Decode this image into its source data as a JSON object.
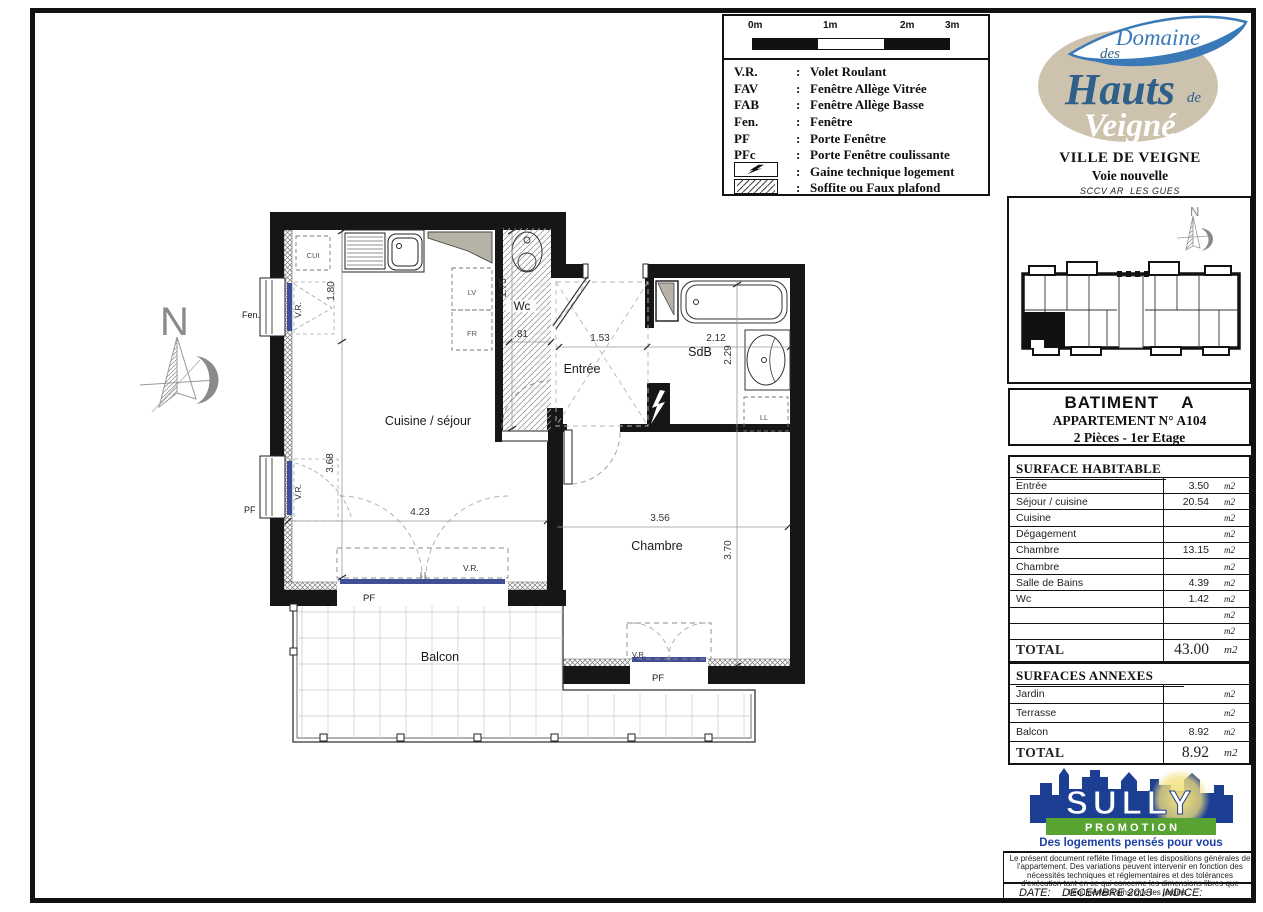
{
  "legend": {
    "scale_labels": [
      "0m",
      "1m",
      "2m",
      "3m"
    ],
    "entries": [
      {
        "abbr": "V.R.",
        "label": "Volet Roulant"
      },
      {
        "abbr": "FAV",
        "label": "Fenêtre Allège Vitrée"
      },
      {
        "abbr": "FAB",
        "label": "Fenêtre Allège Basse"
      },
      {
        "abbr": "Fen.",
        "label": "Fenêtre"
      },
      {
        "abbr": "PF",
        "label": "Porte Fenêtre"
      },
      {
        "abbr": "PFc",
        "label": "Porte Fenêtre coulissante"
      },
      {
        "abbr": "gaine-icon",
        "label": "Gaine technique logement"
      },
      {
        "abbr": "soffite-icon",
        "label": "Soffite ou Faux plafond"
      }
    ]
  },
  "logo": {
    "domaine": "Domaine",
    "des": "des",
    "hauts": "Hauts",
    "de": "de",
    "veigne": "Veigné",
    "city": "VILLE DE VEIGNE",
    "street": "Voie nouvelle",
    "sccv": "SCCV AR  LES GUES"
  },
  "apartment": {
    "building": "BATIMENT    A",
    "number": "APPARTEMENT N° A104",
    "floor": "2 Pièces - 1er Etage"
  },
  "surface_table": {
    "title": "SURFACE HABITABLE",
    "unit": "m2",
    "rows": [
      {
        "label": "Entrée",
        "value": "3.50"
      },
      {
        "label": "Séjour / cuisine",
        "value": "20.54"
      },
      {
        "label": "Cuisine",
        "value": ""
      },
      {
        "label": "Dégagement",
        "value": ""
      },
      {
        "label": "Chambre",
        "value": "13.15"
      },
      {
        "label": "Chambre",
        "value": ""
      },
      {
        "label": "Salle de Bains",
        "value": "4.39"
      },
      {
        "label": "Wc",
        "value": "1.42"
      },
      {
        "label": "",
        "value": ""
      },
      {
        "label": "",
        "value": ""
      }
    ],
    "total_label": "TOTAL",
    "total_value": "43.00"
  },
  "annex_table": {
    "title": "SURFACES ANNEXES",
    "unit": "m2",
    "rows": [
      {
        "label": "Jardin",
        "value": ""
      },
      {
        "label": "Terrasse",
        "value": ""
      },
      {
        "label": "Balcon",
        "value": "8.92"
      }
    ],
    "total_label": "TOTAL",
    "total_value": "8.92"
  },
  "sully": {
    "name": "SULLY",
    "promotion": "P R O M O T I O N",
    "tagline": "Des logements pensés pour vous"
  },
  "footer": {
    "disclaimer": "Le présent document refléte l'image et les dispositions générales de l'appartement. Des variations peuvent intervenir en fonction des nécessités techniques et réglementaires et des tolérances d'exécution tant en ce qui concerne les dimensions libres que l'équipement ainsi que les jardins .",
    "date_label": "DATE:",
    "date_value": "DECEMBRE 2013",
    "indice_label": "INDICE:"
  },
  "plan": {
    "rooms": {
      "kitchen_living": "Cuisine / séjour",
      "entry": "Entrée",
      "bathroom": "SdB",
      "wc": "Wc",
      "bedroom": "Chambre",
      "balcony": "Balcon"
    },
    "dims": {
      "d180": "1.80",
      "d175": "1.75",
      "d081": ".81",
      "d153": "1.53",
      "d212": "2.12",
      "d229": "2.29",
      "d368": "3.68",
      "d423": "4.23",
      "d356": "3.56",
      "d370": "3.70"
    },
    "labels": {
      "vr": "V.R.",
      "pf": "PF",
      "fen": "Fen.",
      "cui": "CUI",
      "lv": "LV",
      "fr": "FR",
      "ll": "LL",
      "north": "N"
    }
  },
  "colors": {
    "wall": "#161616",
    "window_blue": "#3f4e97",
    "soffit_gray": "#b7b2a6",
    "logo_blue": "#3a79b8",
    "logo_beige": "#cdc2ae",
    "script_blue": "#2e6089",
    "sully_blue": "#1c3f94",
    "sully_green": "#58a331",
    "sully_yellow": "#f3e07c"
  }
}
